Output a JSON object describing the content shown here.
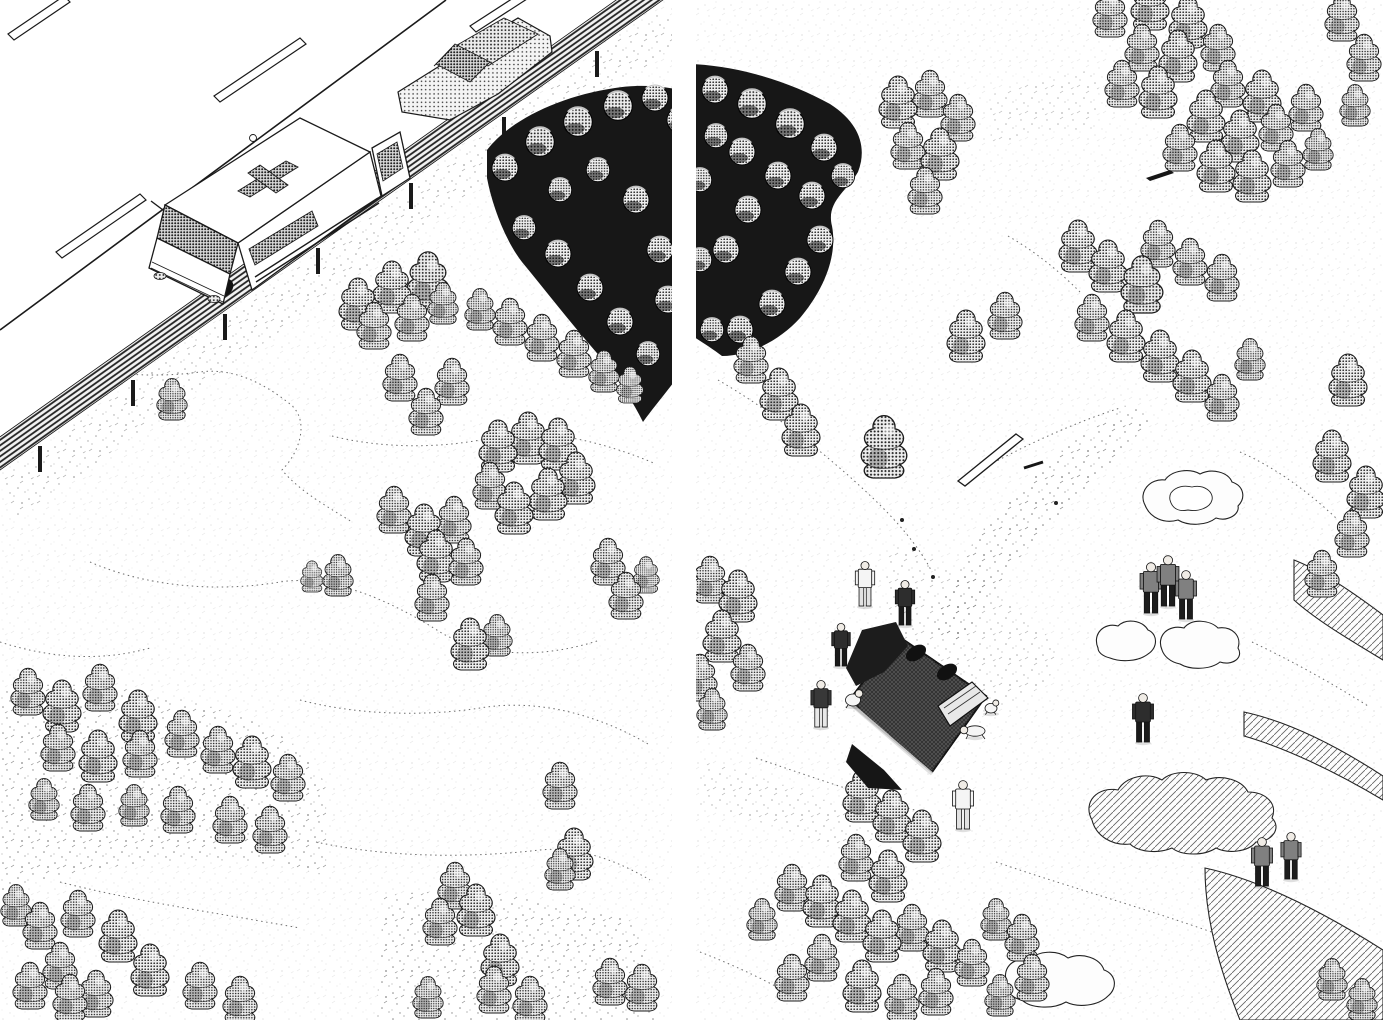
{
  "meta": {
    "type": "manga two-page spread, aerial isometric scene, black ink on white paper",
    "left_panel": "ambulance with open rear door and a sedan stopped on a guard-railed mountain road above a tree-dotted slope",
    "right_panel": "overturned crashed vehicle on the slope with a debris trail, rescuers, casualties on the ground, and uniformed onlookers"
  },
  "palette": {
    "ink": "#1a1a1a",
    "paper": "#ffffff",
    "tone_mid": "#8f8f8f",
    "tone_dark": "#2b2b2b",
    "grove": "#171717"
  },
  "layout": {
    "gutter_x": 672,
    "gutter_w": 24
  },
  "left": {
    "trees": [
      [
        358,
        320,
        1.0
      ],
      [
        392,
        303,
        1.0
      ],
      [
        428,
        298,
        1.1
      ],
      [
        374,
        340,
        0.9
      ],
      [
        412,
        332,
        0.9
      ],
      [
        443,
        316,
        0.8
      ],
      [
        480,
        322,
        0.8
      ],
      [
        510,
        336,
        0.9
      ],
      [
        542,
        352,
        0.9
      ],
      [
        574,
        368,
        0.9
      ],
      [
        604,
        384,
        0.8
      ],
      [
        630,
        396,
        0.7
      ],
      [
        400,
        392,
        0.9
      ],
      [
        452,
        396,
        0.9
      ],
      [
        426,
        426,
        0.9
      ],
      [
        172,
        412,
        0.8
      ],
      [
        498,
        462,
        1.0
      ],
      [
        528,
        454,
        1.0
      ],
      [
        558,
        460,
        1.0
      ],
      [
        576,
        494,
        1.0
      ],
      [
        548,
        510,
        1.0
      ],
      [
        514,
        524,
        1.0
      ],
      [
        490,
        500,
        0.9
      ],
      [
        394,
        524,
        0.9
      ],
      [
        424,
        546,
        1.0
      ],
      [
        454,
        534,
        0.9
      ],
      [
        436,
        572,
        1.0
      ],
      [
        466,
        576,
        0.9
      ],
      [
        338,
        588,
        0.8
      ],
      [
        312,
        586,
        0.6
      ],
      [
        608,
        576,
        0.9
      ],
      [
        626,
        610,
        0.9
      ],
      [
        646,
        586,
        0.7
      ],
      [
        432,
        612,
        0.9
      ],
      [
        470,
        660,
        1.0
      ],
      [
        497,
        648,
        0.8
      ],
      [
        560,
        800,
        0.9
      ],
      [
        574,
        870,
        1.0
      ],
      [
        28,
        706,
        0.9
      ],
      [
        62,
        722,
        1.0
      ],
      [
        100,
        702,
        0.9
      ],
      [
        138,
        732,
        1.0
      ],
      [
        58,
        762,
        0.9
      ],
      [
        98,
        772,
        1.0
      ],
      [
        140,
        768,
        0.9
      ],
      [
        182,
        748,
        0.9
      ],
      [
        218,
        764,
        0.9
      ],
      [
        252,
        778,
        1.0
      ],
      [
        288,
        792,
        0.9
      ],
      [
        44,
        812,
        0.8
      ],
      [
        88,
        822,
        0.9
      ],
      [
        134,
        818,
        0.8
      ],
      [
        178,
        824,
        0.9
      ],
      [
        230,
        834,
        0.9
      ],
      [
        270,
        844,
        0.9
      ],
      [
        16,
        918,
        0.8
      ],
      [
        40,
        940,
        0.9
      ],
      [
        78,
        928,
        0.9
      ],
      [
        118,
        952,
        1.0
      ],
      [
        60,
        980,
        0.9
      ],
      [
        150,
        986,
        1.0
      ],
      [
        200,
        1000,
        0.9
      ],
      [
        240,
        1014,
        0.9
      ],
      [
        96,
        1008,
        0.9
      ],
      [
        30,
        1000,
        0.9
      ],
      [
        70,
        1012,
        0.9
      ],
      [
        455,
        900,
        0.9
      ],
      [
        476,
        926,
        1.0
      ],
      [
        440,
        936,
        0.9
      ],
      [
        500,
        976,
        1.0
      ],
      [
        494,
        1004,
        0.9
      ],
      [
        560,
        882,
        0.8
      ],
      [
        610,
        996,
        0.9
      ],
      [
        642,
        1002,
        0.9
      ],
      [
        428,
        1010,
        0.8
      ],
      [
        530,
        1014,
        0.9
      ]
    ],
    "groves": [
      {
        "d": "M487,150 C510,120 560,96 615,88 C640,84 665,86 690,92 L690,360 C672,386 655,405 643,422 C630,396 615,375 596,352 C570,322 545,290 522,262 C505,240 492,205 487,178 Z",
        "bumps": [
          [
            505,
            168,
            1.0
          ],
          [
            540,
            142,
            1.1
          ],
          [
            578,
            122,
            1.1
          ],
          [
            618,
            106,
            1.1
          ],
          [
            655,
            98,
            1.0
          ],
          [
            680,
            120,
            1.0
          ],
          [
            524,
            228,
            0.9
          ],
          [
            558,
            254,
            1.0
          ],
          [
            590,
            288,
            1.0
          ],
          [
            620,
            322,
            1.0
          ],
          [
            648,
            354,
            0.9
          ],
          [
            668,
            300,
            1.0
          ],
          [
            660,
            250,
            1.0
          ],
          [
            636,
            200,
            1.0
          ],
          [
            598,
            170,
            0.9
          ],
          [
            560,
            190,
            0.9
          ]
        ]
      }
    ],
    "contours": [
      "M30,350 C80,372 140,380 200,372 C230,368 260,380 290,404 C310,420 300,452 282,470 C300,492 330,508 352,522",
      "M332,436 C380,448 440,450 500,436 C540,428 600,440 656,464",
      "M90,562 C150,588 220,592 280,582 C330,574 390,600 440,632 C480,656 540,660 600,640",
      "M0,642 C50,658 100,662 150,648",
      "M300,700 C360,716 430,716 480,708 C540,698 600,716 648,744",
      "M316,842 C390,858 470,858 540,850 C580,846 620,862 650,880",
      "M60,882 C130,900 210,912 300,928"
    ],
    "speckles": [
      {
        "d": "M0,478 L660,10 L686,38 L18,520 Z",
        "op": 0.35
      },
      {
        "d": "M0,690 C80,676 180,692 260,724 C300,744 320,766 326,790 L326,876 C240,850 120,856 0,892 Z",
        "op": 0.5
      },
      {
        "d": "M384,896 C470,884 560,898 640,924 L660,1020 L376,1020 Z",
        "op": 0.5
      }
    ]
  },
  "right": {
    "trees": [
      [
        898,
        118,
        1.0
      ],
      [
        930,
        108,
        0.9
      ],
      [
        958,
        132,
        0.9
      ],
      [
        908,
        160,
        0.9
      ],
      [
        940,
        170,
        1.0
      ],
      [
        925,
        205,
        0.9
      ],
      [
        751,
        374,
        0.9
      ],
      [
        779,
        410,
        1.0
      ],
      [
        801,
        446,
        1.0
      ],
      [
        884,
        466,
        1.2
      ],
      [
        966,
        352,
        1.0
      ],
      [
        1005,
        330,
        0.9
      ],
      [
        710,
        594,
        0.9
      ],
      [
        738,
        612,
        1.0
      ],
      [
        722,
        652,
        1.0
      ],
      [
        700,
        692,
        0.9
      ],
      [
        748,
        682,
        0.9
      ],
      [
        712,
        722,
        0.8
      ],
      [
        1110,
        28,
        0.9
      ],
      [
        1150,
        20,
        1.0
      ],
      [
        1188,
        38,
        1.0
      ],
      [
        1142,
        62,
        0.9
      ],
      [
        1178,
        72,
        1.0
      ],
      [
        1218,
        62,
        0.9
      ],
      [
        1122,
        98,
        0.9
      ],
      [
        1158,
        108,
        1.0
      ],
      [
        1228,
        98,
        0.9
      ],
      [
        1262,
        112,
        1.0
      ],
      [
        1206,
        132,
        1.0
      ],
      [
        1240,
        152,
        1.0
      ],
      [
        1276,
        142,
        0.9
      ],
      [
        1306,
        122,
        0.9
      ],
      [
        1180,
        162,
        0.9
      ],
      [
        1216,
        182,
        1.0
      ],
      [
        1252,
        192,
        1.0
      ],
      [
        1288,
        178,
        0.9
      ],
      [
        1318,
        162,
        0.8
      ],
      [
        1342,
        32,
        0.9
      ],
      [
        1364,
        72,
        0.9
      ],
      [
        1355,
        118,
        0.8
      ],
      [
        1078,
        262,
        1.0
      ],
      [
        1108,
        282,
        1.0
      ],
      [
        1142,
        302,
        1.1
      ],
      [
        1092,
        332,
        0.9
      ],
      [
        1126,
        352,
        1.0
      ],
      [
        1160,
        372,
        1.0
      ],
      [
        1192,
        392,
        1.0
      ],
      [
        1158,
        258,
        0.9
      ],
      [
        1190,
        276,
        0.9
      ],
      [
        1222,
        292,
        0.9
      ],
      [
        1222,
        412,
        0.9
      ],
      [
        1250,
        372,
        0.8
      ],
      [
        1348,
        396,
        1.0
      ],
      [
        1332,
        472,
        1.0
      ],
      [
        1366,
        508,
        1.0
      ],
      [
        1352,
        548,
        0.9
      ],
      [
        1322,
        588,
        0.9
      ],
      [
        862,
        812,
        1.0
      ],
      [
        892,
        832,
        1.0
      ],
      [
        922,
        852,
        1.0
      ],
      [
        856,
        872,
        0.9
      ],
      [
        888,
        892,
        1.0
      ],
      [
        792,
        902,
        0.9
      ],
      [
        822,
        917,
        1.0
      ],
      [
        852,
        932,
        1.0
      ],
      [
        882,
        952,
        1.0
      ],
      [
        912,
        942,
        0.9
      ],
      [
        942,
        962,
        1.0
      ],
      [
        972,
        977,
        0.9
      ],
      [
        822,
        972,
        0.9
      ],
      [
        792,
        992,
        0.9
      ],
      [
        862,
        1002,
        1.0
      ],
      [
        902,
        1012,
        0.9
      ],
      [
        996,
        932,
        0.8
      ],
      [
        1022,
        952,
        0.9
      ],
      [
        1032,
        992,
        0.9
      ],
      [
        762,
        932,
        0.8
      ],
      [
        936,
        1006,
        0.9
      ],
      [
        1000,
        1008,
        0.8
      ],
      [
        1332,
        992,
        0.8
      ],
      [
        1362,
        1012,
        0.8
      ]
    ],
    "groves": [
      {
        "d": "M690,64 C740,66 790,82 830,104 C858,122 868,146 858,172 C846,192 826,202 832,226 C838,258 822,292 800,318 C780,340 750,356 722,356 C712,348 698,340 690,334 Z",
        "bumps": [
          [
            715,
            90,
            1.0
          ],
          [
            752,
            104,
            1.1
          ],
          [
            790,
            124,
            1.1
          ],
          [
            824,
            148,
            1.0
          ],
          [
            843,
            176,
            0.9
          ],
          [
            812,
            196,
            1.0
          ],
          [
            778,
            176,
            1.0
          ],
          [
            742,
            152,
            1.0
          ],
          [
            716,
            136,
            0.9
          ],
          [
            820,
            240,
            1.0
          ],
          [
            798,
            272,
            1.0
          ],
          [
            772,
            304,
            1.0
          ],
          [
            740,
            330,
            1.0
          ],
          [
            712,
            330,
            0.9
          ],
          [
            726,
            250,
            1.0
          ],
          [
            748,
            210,
            1.0
          ],
          [
            700,
            180,
            0.9
          ],
          [
            700,
            260,
            0.9
          ]
        ]
      }
    ],
    "contours": [
      "M718,380 C770,410 830,456 880,505 C905,530 922,552 932,572",
      "M980,470 C1020,448 1070,424 1120,408",
      "M1240,452 C1272,466 1304,488 1336,518",
      "M756,758 C820,780 880,800 928,814",
      "M996,862 C1060,884 1130,904 1200,928 C1230,938 1260,952 1286,968",
      "M1252,642 C1290,660 1330,682 1368,706",
      "M700,952 C736,966 770,982 800,1000",
      "M1008,236 C1036,252 1060,272 1080,292"
    ],
    "speckles": [
      {
        "d": "M1132,402 C1080,432 1018,484 974,542 C952,574 938,604 930,628 L962,646 C982,602 1014,560 1062,512 C1104,470 1134,440 1150,420 Z",
        "op": 0.55
      },
      {
        "d": "M892,545 C955,560 1030,605 1062,655 C1040,706 980,724 928,702 C890,660 878,592 892,545 Z",
        "op": 0.3
      },
      {
        "d": "M988,96 C1030,80 1070,72 1100,70 L1096,130 C1056,128 1020,134 992,146 Z",
        "op": 0.25
      },
      {
        "d": "M700,760 C760,776 830,800 880,824 L870,860 C810,836 750,818 700,806 Z",
        "op": 0.3
      }
    ],
    "rocks": [
      {
        "d": "M1145,505 C1138,492 1150,478 1165,480 C1172,470 1190,468 1200,474 C1212,468 1228,472 1232,482 C1244,486 1246,498 1238,506 C1240,514 1228,522 1216,518 C1206,526 1188,526 1178,520 C1164,524 1150,518 1145,505 Z",
        "inner": "M1170,500 C1168,490 1180,484 1192,487 C1204,484 1214,492 1212,500 C1210,508 1198,512 1188,510 C1178,512 1172,508 1170,500 Z",
        "shaded": false
      },
      {
        "d": "M1098,648 C1092,634 1104,622 1118,626 C1126,618 1142,620 1148,630 C1158,634 1158,648 1148,654 C1138,662 1120,662 1110,658 C1102,656 1098,652 1098,648 Z",
        "shaded": false
      },
      {
        "d": "M1162,650 C1156,636 1168,624 1184,628 C1192,618 1210,620 1218,628 C1232,626 1242,636 1238,648 C1244,658 1232,666 1220,662 C1210,670 1190,670 1180,664 C1170,662 1164,656 1162,650 Z",
        "shaded": false
      },
      {
        "d": "M1092,820 C1082,802 1098,786 1118,790 C1126,776 1148,772 1162,780 C1172,770 1196,770 1206,780 C1222,774 1242,780 1248,792 C1266,792 1278,804 1272,818 C1282,828 1272,842 1256,842 C1248,852 1228,854 1216,848 C1204,856 1182,856 1172,848 C1158,854 1138,852 1130,844 C1112,846 1096,836 1092,820 Z",
        "shaded": true
      },
      {
        "d": "M1008,985 C1000,970 1012,956 1030,960 C1038,950 1058,950 1068,958 C1082,952 1100,958 1104,970 C1116,974 1118,988 1108,996 C1098,1006 1078,1008 1066,1002 C1052,1010 1030,1008 1022,1000 C1012,998 1006,992 1008,985 Z",
        "shaded": false
      },
      {
        "d": "M1205,868 C1260,880 1320,910 1383,950 L1383,1020 L1240,1020 C1220,970 1205,920 1205,868 Z",
        "shaded": true
      },
      {
        "d": "M1294,560 C1320,570 1350,590 1383,615 L1383,660 C1350,640 1316,620 1294,600 Z",
        "shaded": true
      },
      {
        "d": "M1244,712 C1290,722 1340,748 1383,776 L1383,800 C1336,772 1286,748 1244,736 Z",
        "shaded": true
      }
    ],
    "debris": [
      {
        "kind": "plank",
        "pts": "958,481 1016,434 1023,439 965,486"
      },
      {
        "kind": "streak",
        "x1": 1024,
        "y1": 468,
        "x2": 1043,
        "y2": 462
      },
      {
        "kind": "pole",
        "pts": "1146,178 1170,170 1174,173 1150,181"
      },
      {
        "kind": "arrow",
        "x1": 1206,
        "y1": 174,
        "x2": 1222,
        "y2": 170
      },
      {
        "kind": "tent",
        "pts": "1260,101 1269,85 1280,101"
      },
      {
        "kind": "dot",
        "x": 1056,
        "y": 503
      },
      {
        "kind": "dot",
        "x": 914,
        "y": 549
      },
      {
        "kind": "dot",
        "x": 933,
        "y": 577
      },
      {
        "kind": "dot",
        "x": 902,
        "y": 520
      }
    ],
    "people": [
      {
        "x": 865,
        "y": 606,
        "pose": "standing",
        "tone": "light",
        "role": "rescuer",
        "h": 46
      },
      {
        "x": 905,
        "y": 625,
        "pose": "standing",
        "tone": "dark",
        "role": "rescuer",
        "h": 46
      },
      {
        "x": 841,
        "y": 666,
        "pose": "standing",
        "tone": "dark",
        "role": "rescuer",
        "h": 44
      },
      {
        "x": 821,
        "y": 727,
        "pose": "standing",
        "tone": "mixed",
        "role": "rescuer",
        "h": 48
      },
      {
        "x": 853,
        "y": 706,
        "pose": "crouching",
        "tone": "light",
        "role": "rescuer",
        "h": 30
      },
      {
        "x": 975,
        "y": 737,
        "pose": "crawling",
        "tone": "light",
        "role": "casualty",
        "h": 30
      },
      {
        "x": 991,
        "y": 713,
        "pose": "crouching",
        "tone": "light",
        "role": "casualty",
        "h": 24
      },
      {
        "x": 963,
        "y": 829,
        "pose": "standing",
        "tone": "light",
        "role": "onlooker",
        "h": 50
      },
      {
        "x": 1151,
        "y": 613,
        "pose": "standing",
        "tone": "uniform",
        "role": "officer",
        "h": 52
      },
      {
        "x": 1168,
        "y": 606,
        "pose": "standing",
        "tone": "uniform",
        "role": "officer",
        "h": 52
      },
      {
        "x": 1186,
        "y": 619,
        "pose": "standing",
        "tone": "uniform",
        "role": "officer",
        "h": 50
      },
      {
        "x": 1143,
        "y": 742,
        "pose": "standing",
        "tone": "dark",
        "role": "onlooker",
        "h": 50
      },
      {
        "x": 1262,
        "y": 886,
        "pose": "standing",
        "tone": "uniform",
        "role": "officer",
        "h": 50
      },
      {
        "x": 1291,
        "y": 879,
        "pose": "standing",
        "tone": "uniform",
        "role": "officer",
        "h": 48
      }
    ]
  }
}
